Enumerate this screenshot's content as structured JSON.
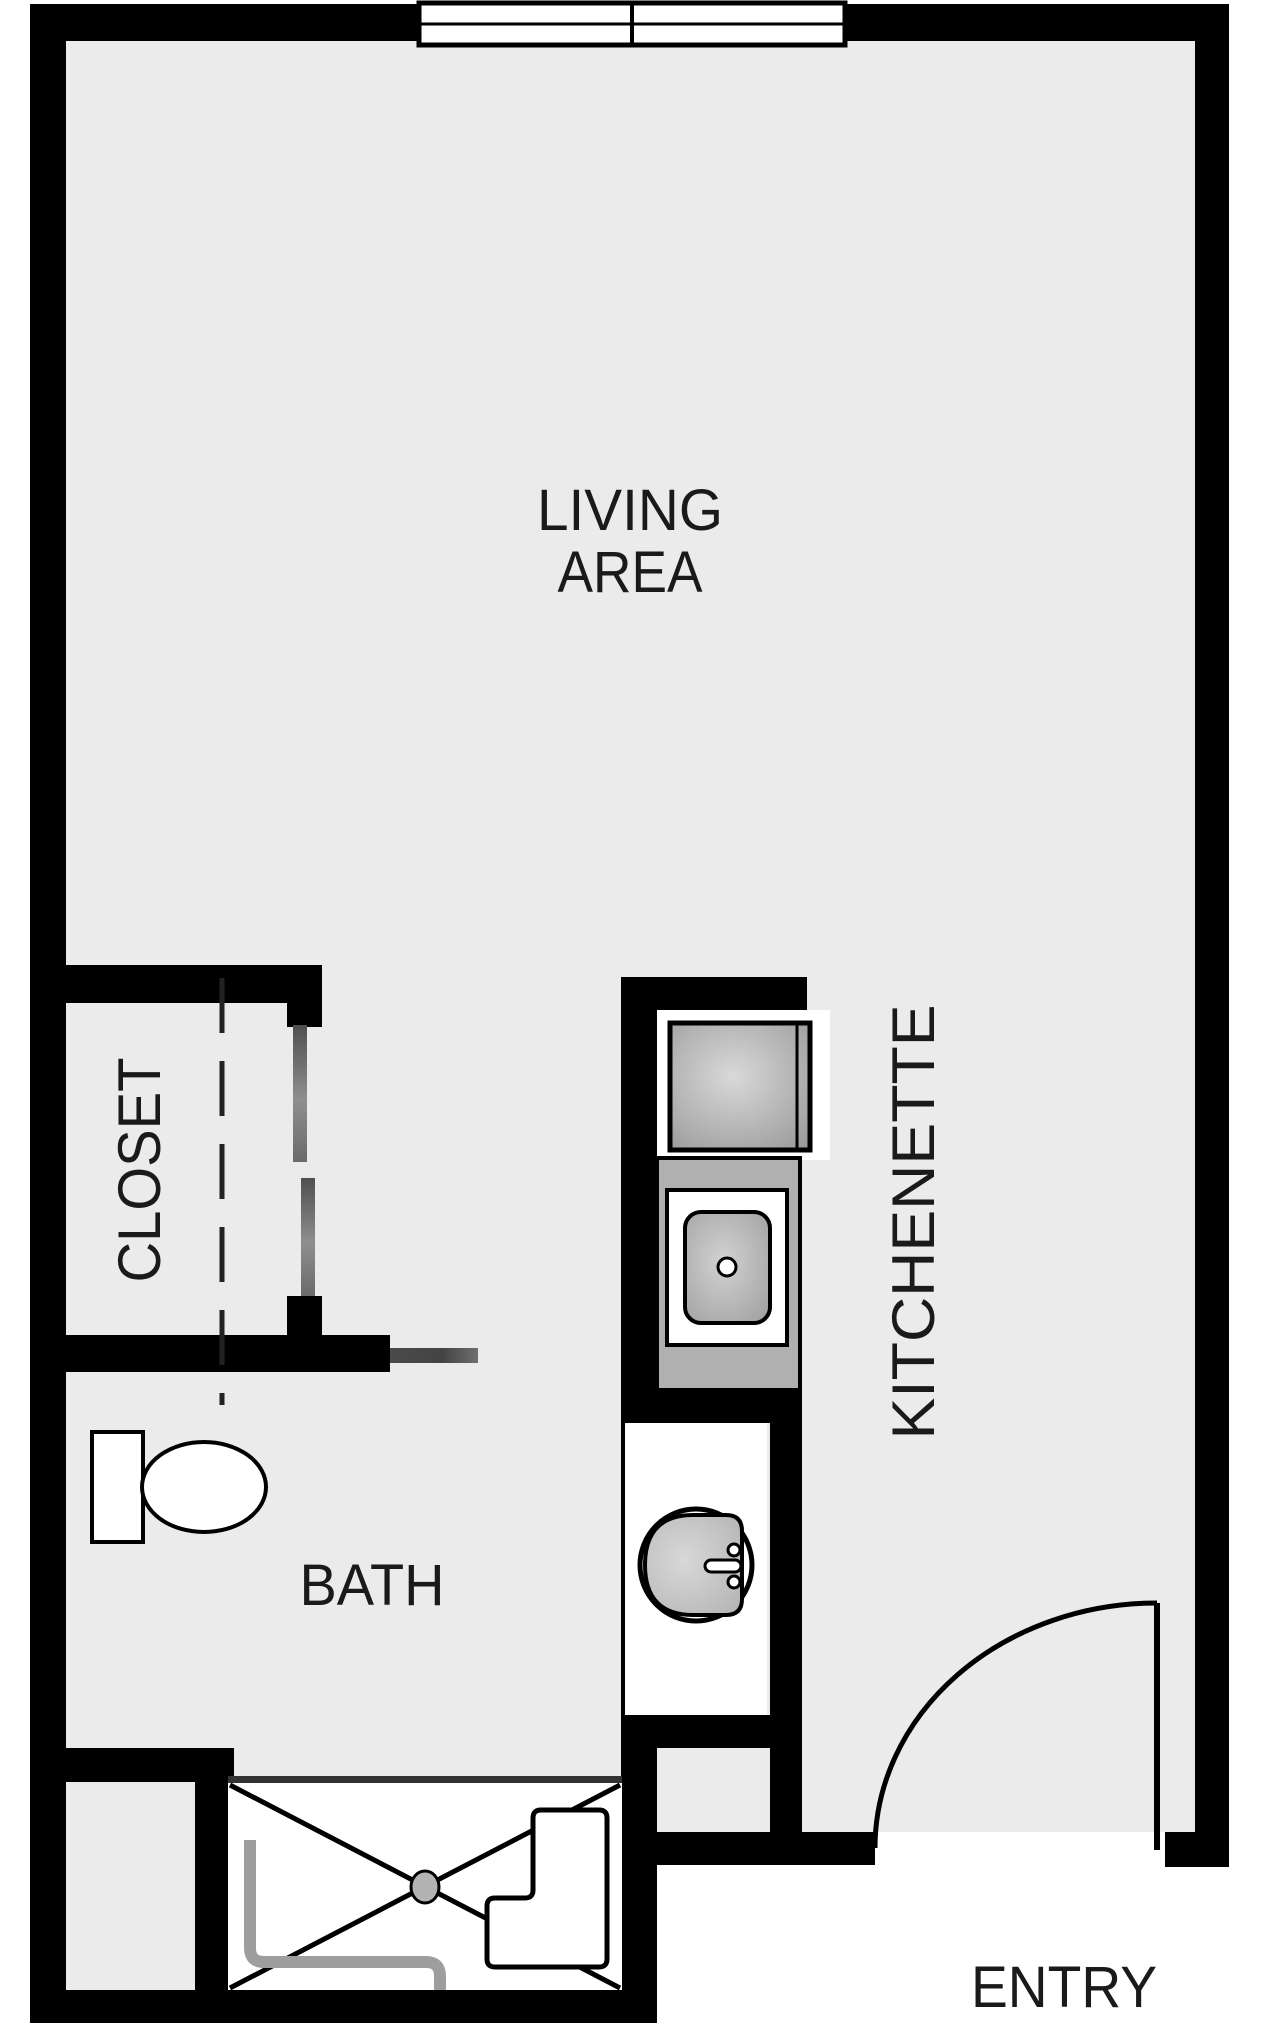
{
  "plan": {
    "labels": {
      "living_line1": "LIVING",
      "living_line2": "AREA",
      "closet": "CLOSET",
      "kitchenette": "KITCHENETTE",
      "bath": "BATH",
      "entry": "ENTRY"
    },
    "colors": {
      "floor": "#ebebeb",
      "wall": "#000000",
      "counter": "#b0b0b0",
      "shower_edge": "#333333",
      "grab_bar": "#9e9e9e",
      "slider_door": "#5a5a5a",
      "label_text": "#1a1a1a",
      "fixture_fill": "#ffffff"
    },
    "fixtures": [
      "window",
      "closet-bifold-doors",
      "bath-sliding-door",
      "range",
      "kitchen-sink",
      "bathroom-sink",
      "toilet",
      "shower",
      "shower-bench",
      "grab-bar",
      "entry-door"
    ]
  }
}
